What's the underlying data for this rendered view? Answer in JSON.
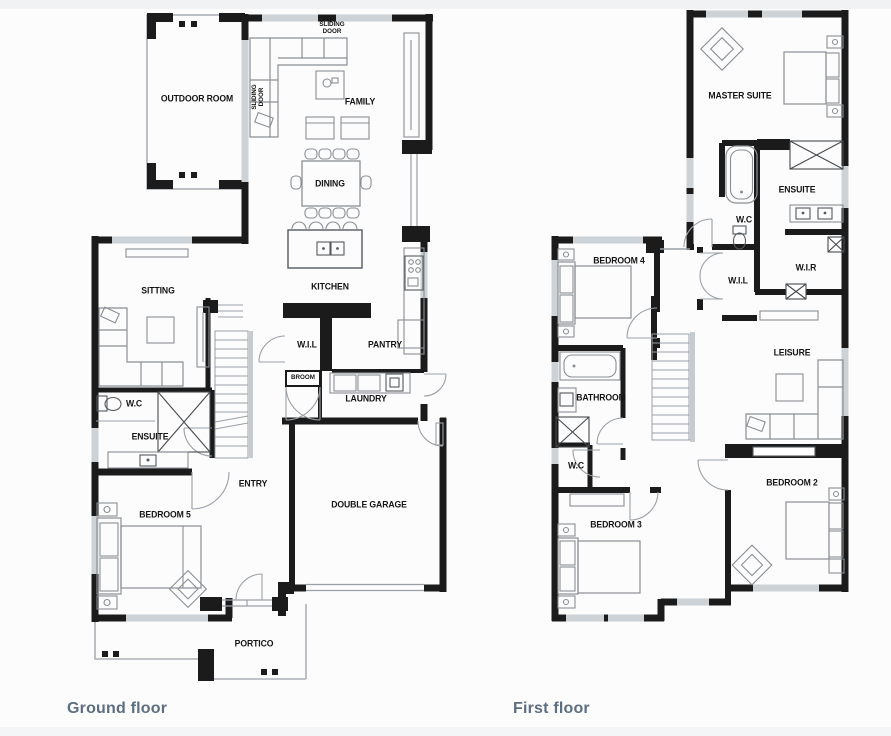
{
  "page": {
    "background": "#fcfcfd"
  },
  "colors": {
    "wall": "#1b1b1b",
    "furniture": "#8a8f94",
    "window": "#cdd2d6",
    "caption": "#5d6e80",
    "label": "#141414"
  },
  "captions": {
    "ground": "Ground floor",
    "first": "First floor"
  },
  "ground_floor": {
    "rooms": {
      "outdoor_room": "OUTDOOR ROOM",
      "family": "FAMILY",
      "dining": "DINING",
      "kitchen": "KITCHEN",
      "sitting": "SITTING",
      "wil": "W.I.L",
      "pantry": "PANTRY",
      "broom": "BROOM",
      "laundry": "LAUNDRY",
      "wc": "W.C",
      "ensuite": "ENSUITE",
      "entry": "ENTRY",
      "bedroom5": "BEDROOM 5",
      "double_garage": "DOUBLE GARAGE",
      "portico": "PORTICO"
    },
    "annotations": {
      "sliding_door_top": "SLIDING DOOR",
      "sliding_door_side": "SLIDING DOOR"
    }
  },
  "first_floor": {
    "rooms": {
      "master_suite": "MASTER SUITE",
      "ensuite": "ENSUITE",
      "wc_upper": "W.C",
      "bedroom4": "BEDROOM 4",
      "wil": "W.I.L",
      "wir": "W.I.R",
      "leisure": "LEISURE",
      "bathroom": "BATHROOM",
      "wc_lower": "W.C",
      "bedroom3": "BEDROOM 3",
      "bedroom2": "BEDROOM 2"
    }
  }
}
